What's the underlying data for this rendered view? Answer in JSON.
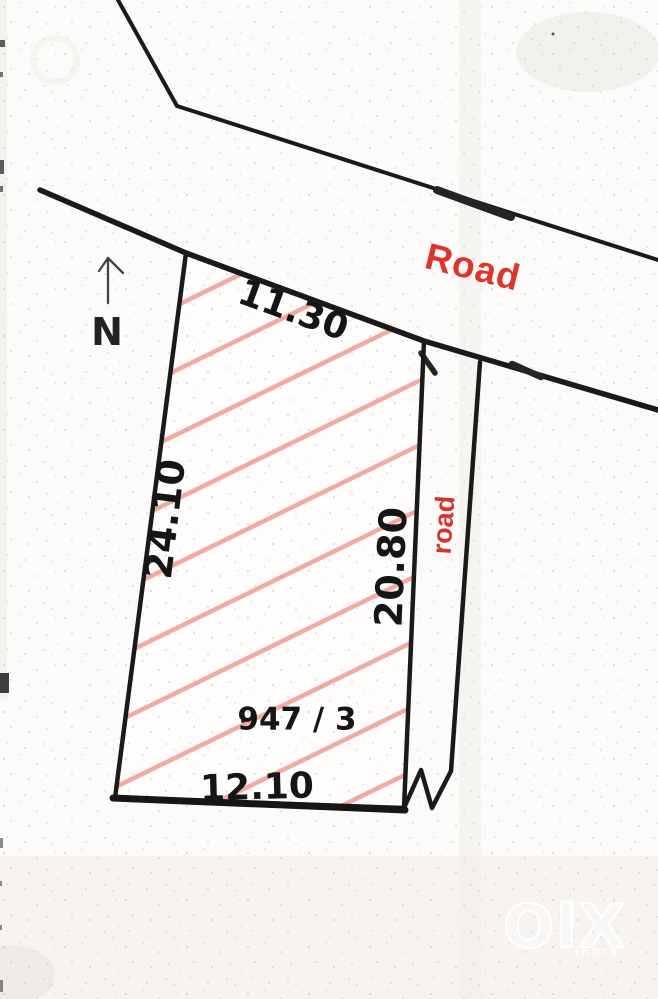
{
  "sketch": {
    "type": "land-plot-survey-sketch",
    "north_label": "N",
    "road_top_label": "Road",
    "road_right_label": "road",
    "plot_number": "947 / 3",
    "dimensions": {
      "top": "11.30",
      "left": "24.10",
      "right": "20.80",
      "bottom": "12.10"
    }
  },
  "watermark": {
    "brand": "OlX",
    "country": "INDIA"
  },
  "colors": {
    "line_black": "#1a1a1a",
    "road_label_red": "#dd342c",
    "hatch_pink": "#f2a9a3",
    "paper": "#fcfbf9"
  }
}
